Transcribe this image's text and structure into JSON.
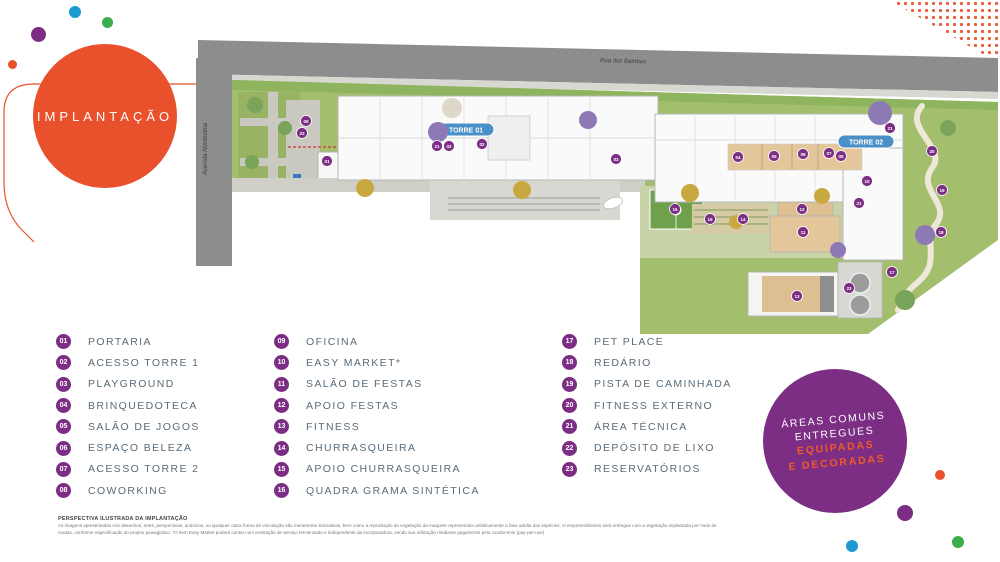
{
  "title": {
    "label": "IMPLANTAÇÃO"
  },
  "plan": {
    "street_top": "Rua dos Bambus",
    "street_left": "Avenida Nordestina",
    "tower1_label": "TORRE 01",
    "tower2_label": "TORRE 02",
    "markers": [
      {
        "n": "01",
        "x": 327,
        "y": 161
      },
      {
        "n": "02",
        "x": 449,
        "y": 146
      },
      {
        "n": "02",
        "x": 482,
        "y": 144
      },
      {
        "n": "03",
        "x": 616,
        "y": 159
      },
      {
        "n": "04",
        "x": 738,
        "y": 157
      },
      {
        "n": "05",
        "x": 774,
        "y": 156
      },
      {
        "n": "06",
        "x": 803,
        "y": 154
      },
      {
        "n": "07",
        "x": 829,
        "y": 153
      },
      {
        "n": "08",
        "x": 841,
        "y": 156
      },
      {
        "n": "09",
        "x": 306,
        "y": 121
      },
      {
        "n": "10",
        "x": 867,
        "y": 181
      },
      {
        "n": "11",
        "x": 803,
        "y": 232
      },
      {
        "n": "12",
        "x": 802,
        "y": 209
      },
      {
        "n": "13",
        "x": 797,
        "y": 296
      },
      {
        "n": "14",
        "x": 743,
        "y": 219
      },
      {
        "n": "15",
        "x": 710,
        "y": 219
      },
      {
        "n": "16",
        "x": 675,
        "y": 209
      },
      {
        "n": "17",
        "x": 892,
        "y": 272
      },
      {
        "n": "18",
        "x": 941,
        "y": 232
      },
      {
        "n": "19",
        "x": 942,
        "y": 190
      },
      {
        "n": "20",
        "x": 932,
        "y": 151
      },
      {
        "n": "21",
        "x": 437,
        "y": 146
      },
      {
        "n": "21",
        "x": 859,
        "y": 203
      },
      {
        "n": "21",
        "x": 890,
        "y": 128
      },
      {
        "n": "22",
        "x": 302,
        "y": 133
      },
      {
        "n": "23",
        "x": 849,
        "y": 288
      }
    ]
  },
  "legend": {
    "columns": [
      [
        {
          "num": "01",
          "label": "PORTARIA"
        },
        {
          "num": "02",
          "label": "ACESSO TORRE 1"
        },
        {
          "num": "03",
          "label": "PLAYGROUND"
        },
        {
          "num": "04",
          "label": "BRINQUEDOTECA"
        },
        {
          "num": "05",
          "label": "SALÃO DE JOGOS"
        },
        {
          "num": "06",
          "label": "ESPAÇO BELEZA"
        },
        {
          "num": "07",
          "label": "ACESSO TORRE 2"
        },
        {
          "num": "08",
          "label": "COWORKING"
        }
      ],
      [
        {
          "num": "09",
          "label": "OFICINA"
        },
        {
          "num": "10",
          "label": "EASY MARKET*"
        },
        {
          "num": "11",
          "label": "SALÃO DE FESTAS"
        },
        {
          "num": "12",
          "label": "APOIO FESTAS"
        },
        {
          "num": "13",
          "label": "FITNESS"
        },
        {
          "num": "14",
          "label": "CHURRASQUEIRA"
        },
        {
          "num": "15",
          "label": "APOIO CHURRASQUEIRA"
        },
        {
          "num": "16",
          "label": "QUADRA GRAMA SINTÉTICA"
        }
      ],
      [
        {
          "num": "17",
          "label": "PET PLACE"
        },
        {
          "num": "18",
          "label": "REDÁRIO"
        },
        {
          "num": "19",
          "label": "PISTA DE CAMINHADA"
        },
        {
          "num": "20",
          "label": "FITNESS EXTERNO"
        },
        {
          "num": "21",
          "label": "ÁREA TÉCNICA"
        },
        {
          "num": "22",
          "label": "DEPÓSITO DE LIXO"
        },
        {
          "num": "23",
          "label": "RESERVATÓRIOS"
        }
      ]
    ]
  },
  "badge_circle": {
    "line1": "ÁREAS COMUNS",
    "line2": "ENTREGUES",
    "line3": "EQUIPADAS",
    "line4": "E DECORADAS"
  },
  "disclaimer": {
    "title": "PERSPECTIVA ILUSTRADA DA IMPLANTAÇÃO",
    "body": "As imagens apresentadas nos desenhos, artes, perspectivas, anúncios, ou qualquer outra forma de veiculação são meramente ilustrativas, bem como a reprodução de vegetação da maquete representam artisticamente a fase adulta das espécies. O empreendimento será entregue com a vegetação implantada por meio de mudas, conforme especificação do projeto paisagístico. *O item Easy Market poderá contar com prestação de serviço terceirizado e independente da incorporadora, sendo sua utilização mediante pagamento pelo condomínio (pay-per-use)."
  },
  "colors": {
    "brand_orange": "#E8512B",
    "brand_purple": "#7B2E83",
    "tower_pill_blue": "#4A90C8",
    "legend_text": "#5A6B78",
    "grass": "#A3BF6E",
    "road": "#8D8D8D"
  }
}
